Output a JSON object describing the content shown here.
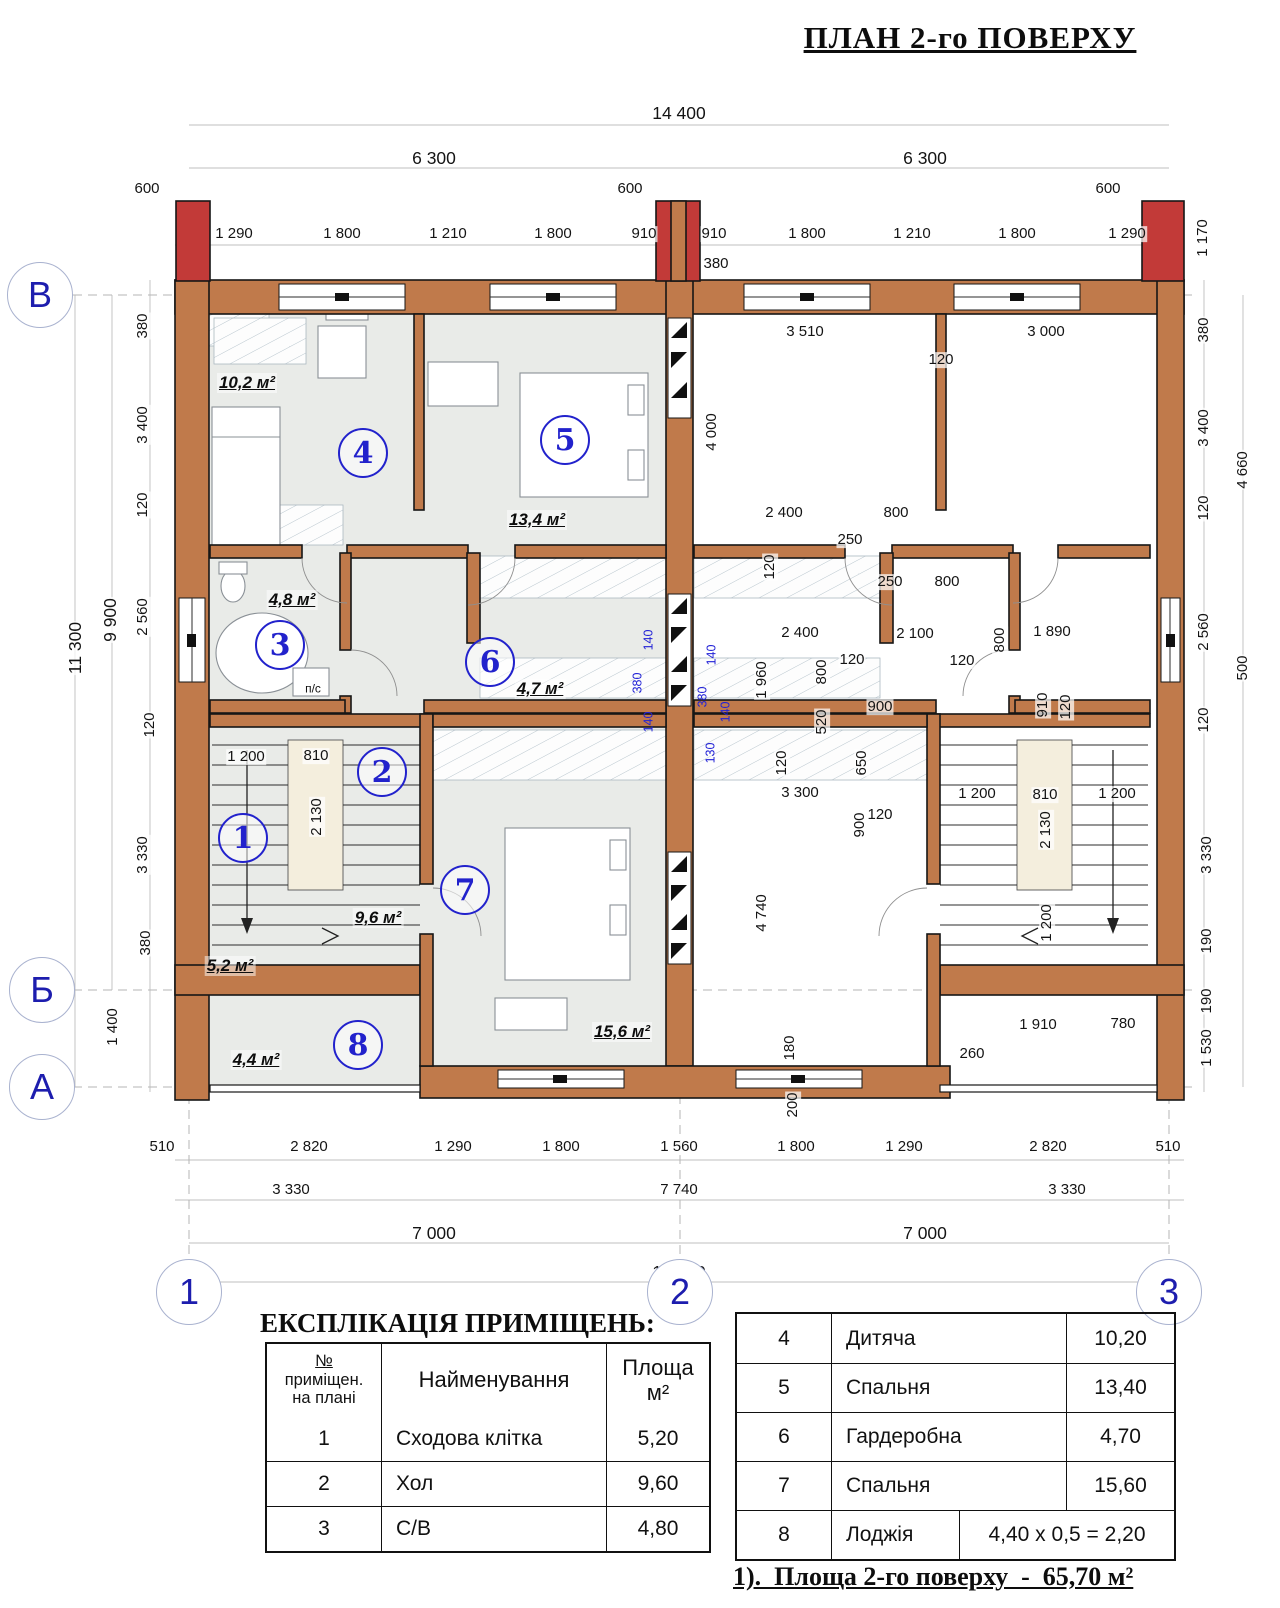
{
  "title": "ПЛАН 2-го ПОВЕРХУ",
  "colors": {
    "wall": "#c07a4b",
    "chimney": "#c23a38",
    "floor": "#e9ebe8",
    "stair_fill": "#f4eedd",
    "accent_blue": "#2222cc",
    "dim_blue": "#2121d6",
    "hatch_line": "#b9c6ce"
  },
  "plan": {
    "axis_circles": [
      {
        "label": "В",
        "x": 40,
        "y": 295
      },
      {
        "label": "Б",
        "x": 42,
        "y": 990
      },
      {
        "label": "А",
        "x": 42,
        "y": 1087
      },
      {
        "label": "1",
        "x": 189,
        "y": 1292
      },
      {
        "label": "2",
        "x": 680,
        "y": 1292
      },
      {
        "label": "3",
        "x": 1169,
        "y": 1292
      }
    ],
    "room_circles": [
      {
        "num": "1",
        "x": 243,
        "y": 838
      },
      {
        "num": "2",
        "x": 382,
        "y": 772
      },
      {
        "num": "3",
        "x": 280,
        "y": 645
      },
      {
        "num": "4",
        "x": 363,
        "y": 453
      },
      {
        "num": "5",
        "x": 565,
        "y": 440
      },
      {
        "num": "6",
        "x": 490,
        "y": 662
      },
      {
        "num": "7",
        "x": 465,
        "y": 890
      },
      {
        "num": "8",
        "x": 358,
        "y": 1045
      }
    ],
    "area_labels": [
      {
        "t": "10,2 м²",
        "x": 247,
        "y": 383
      },
      {
        "t": "13,4 м²",
        "x": 537,
        "y": 520
      },
      {
        "t": "4,8 м²",
        "x": 292,
        "y": 600
      },
      {
        "t": "4,7 м²",
        "x": 540,
        "y": 689
      },
      {
        "t": "9,6 м²",
        "x": 378,
        "y": 918
      },
      {
        "t": "5,2 м²",
        "x": 230,
        "y": 966
      },
      {
        "t": "15,6 м²",
        "x": 622,
        "y": 1032
      },
      {
        "t": "4,4 м²",
        "x": 256,
        "y": 1060
      }
    ],
    "dim_labels": [
      {
        "t": "14 400",
        "x": 679,
        "y": 113,
        "b": 1
      },
      {
        "t": "6 300",
        "x": 434,
        "y": 158,
        "b": 1
      },
      {
        "t": "6 300",
        "x": 925,
        "y": 158,
        "b": 1
      },
      {
        "t": "600",
        "x": 147,
        "y": 189
      },
      {
        "t": "600",
        "x": 630,
        "y": 189
      },
      {
        "t": "600",
        "x": 1108,
        "y": 189
      },
      {
        "t": "1 290",
        "x": 234,
        "y": 234
      },
      {
        "t": "1 800",
        "x": 342,
        "y": 234
      },
      {
        "t": "1 210",
        "x": 448,
        "y": 234
      },
      {
        "t": "1 800",
        "x": 553,
        "y": 234
      },
      {
        "t": "910",
        "x": 644,
        "y": 234
      },
      {
        "t": "910",
        "x": 714,
        "y": 234
      },
      {
        "t": "1 800",
        "x": 807,
        "y": 234
      },
      {
        "t": "1 210",
        "x": 912,
        "y": 234
      },
      {
        "t": "1 800",
        "x": 1017,
        "y": 234
      },
      {
        "t": "1 290",
        "x": 1127,
        "y": 234
      },
      {
        "t": "380",
        "x": 716,
        "y": 264
      },
      {
        "t": "1 170",
        "x": 1203,
        "y": 238,
        "r": 1
      },
      {
        "t": "11 300",
        "x": 75,
        "y": 648,
        "r": 1,
        "b": 1
      },
      {
        "t": "9 900",
        "x": 110,
        "y": 620,
        "r": 1,
        "b": 1
      },
      {
        "t": "380",
        "x": 143,
        "y": 326,
        "r": 1
      },
      {
        "t": "3 400",
        "x": 143,
        "y": 425,
        "r": 1
      },
      {
        "t": "120",
        "x": 143,
        "y": 505,
        "r": 1
      },
      {
        "t": "2 560",
        "x": 143,
        "y": 617,
        "r": 1
      },
      {
        "t": "120",
        "x": 150,
        "y": 725,
        "r": 1
      },
      {
        "t": "3 330",
        "x": 143,
        "y": 855,
        "r": 1
      },
      {
        "t": "380",
        "x": 146,
        "y": 943,
        "r": 1
      },
      {
        "t": "1 400",
        "x": 113,
        "y": 1027,
        "r": 1
      },
      {
        "t": "380",
        "x": 1204,
        "y": 330,
        "r": 1
      },
      {
        "t": "3 400",
        "x": 1204,
        "y": 428,
        "r": 1
      },
      {
        "t": "4 660",
        "x": 1243,
        "y": 470,
        "r": 1
      },
      {
        "t": "120",
        "x": 1204,
        "y": 508,
        "r": 1
      },
      {
        "t": "2 560",
        "x": 1204,
        "y": 632,
        "r": 1
      },
      {
        "t": "500",
        "x": 1243,
        "y": 668,
        "r": 1
      },
      {
        "t": "120",
        "x": 1204,
        "y": 720,
        "r": 1
      },
      {
        "t": "3 330",
        "x": 1207,
        "y": 855,
        "r": 1
      },
      {
        "t": "190",
        "x": 1207,
        "y": 941,
        "r": 1
      },
      {
        "t": "190",
        "x": 1207,
        "y": 1001,
        "r": 1
      },
      {
        "t": "1 530",
        "x": 1207,
        "y": 1048,
        "r": 1
      },
      {
        "t": "510",
        "x": 162,
        "y": 1147
      },
      {
        "t": "2 820",
        "x": 309,
        "y": 1147
      },
      {
        "t": "1 290",
        "x": 453,
        "y": 1147
      },
      {
        "t": "1 800",
        "x": 561,
        "y": 1147
      },
      {
        "t": "1 560",
        "x": 679,
        "y": 1147
      },
      {
        "t": "1 800",
        "x": 796,
        "y": 1147
      },
      {
        "t": "1 290",
        "x": 904,
        "y": 1147
      },
      {
        "t": "2 820",
        "x": 1048,
        "y": 1147
      },
      {
        "t": "510",
        "x": 1168,
        "y": 1147
      },
      {
        "t": "3 330",
        "x": 291,
        "y": 1190
      },
      {
        "t": "7 740",
        "x": 679,
        "y": 1190
      },
      {
        "t": "3 330",
        "x": 1067,
        "y": 1190
      },
      {
        "t": "7 000",
        "x": 434,
        "y": 1233,
        "b": 1
      },
      {
        "t": "7 000",
        "x": 925,
        "y": 1233,
        "b": 1
      },
      {
        "t": "14 000",
        "x": 679,
        "y": 1272,
        "b": 1
      },
      {
        "t": "1 200",
        "x": 246,
        "y": 757
      },
      {
        "t": "810",
        "x": 316,
        "y": 756
      },
      {
        "t": "2 130",
        "x": 317,
        "y": 817,
        "r": 1
      },
      {
        "t": "п/с",
        "x": 313,
        "y": 689,
        "s": 1
      },
      {
        "t": "3 510",
        "x": 805,
        "y": 332
      },
      {
        "t": "3 000",
        "x": 1046,
        "y": 332
      },
      {
        "t": "120",
        "x": 941,
        "y": 360
      },
      {
        "t": "4 000",
        "x": 712,
        "y": 432,
        "r": 1
      },
      {
        "t": "2 400",
        "x": 784,
        "y": 513
      },
      {
        "t": "800",
        "x": 896,
        "y": 513
      },
      {
        "t": "250",
        "x": 850,
        "y": 540
      },
      {
        "t": "120",
        "x": 770,
        "y": 567,
        "r": 1
      },
      {
        "t": "250",
        "x": 890,
        "y": 582
      },
      {
        "t": "800",
        "x": 947,
        "y": 582
      },
      {
        "t": "2 400",
        "x": 800,
        "y": 633
      },
      {
        "t": "2 100",
        "x": 915,
        "y": 634
      },
      {
        "t": "1 890",
        "x": 1052,
        "y": 632
      },
      {
        "t": "800",
        "x": 1000,
        "y": 640,
        "r": 1
      },
      {
        "t": "120",
        "x": 852,
        "y": 660
      },
      {
        "t": "120",
        "x": 962,
        "y": 661
      },
      {
        "t": "1 960",
        "x": 762,
        "y": 680,
        "r": 1
      },
      {
        "t": "800",
        "x": 822,
        "y": 672,
        "r": 1
      },
      {
        "t": "520",
        "x": 822,
        "y": 722,
        "r": 1
      },
      {
        "t": "900",
        "x": 880,
        "y": 707
      },
      {
        "t": "910",
        "x": 1043,
        "y": 705,
        "r": 1
      },
      {
        "t": "120",
        "x": 1066,
        "y": 707,
        "r": 1
      },
      {
        "t": "120",
        "x": 782,
        "y": 763,
        "r": 1
      },
      {
        "t": "650",
        "x": 862,
        "y": 763,
        "r": 1
      },
      {
        "t": "3 300",
        "x": 800,
        "y": 793
      },
      {
        "t": "1 200",
        "x": 977,
        "y": 794
      },
      {
        "t": "810",
        "x": 1045,
        "y": 795
      },
      {
        "t": "1 200",
        "x": 1117,
        "y": 794
      },
      {
        "t": "2 130",
        "x": 1046,
        "y": 830,
        "r": 1
      },
      {
        "t": "900",
        "x": 860,
        "y": 825,
        "r": 1
      },
      {
        "t": "120",
        "x": 880,
        "y": 815
      },
      {
        "t": "4 740",
        "x": 762,
        "y": 913,
        "r": 1
      },
      {
        "t": "1 200",
        "x": 1047,
        "y": 923,
        "r": 1
      },
      {
        "t": "180",
        "x": 790,
        "y": 1048,
        "r": 1
      },
      {
        "t": "200",
        "x": 793,
        "y": 1105,
        "r": 1
      },
      {
        "t": "1 910",
        "x": 1038,
        "y": 1025
      },
      {
        "t": "780",
        "x": 1123,
        "y": 1024
      },
      {
        "t": "260",
        "x": 972,
        "y": 1054
      },
      {
        "t": "140",
        "x": 649,
        "y": 640,
        "r": 1,
        "c": 1
      },
      {
        "t": "380",
        "x": 638,
        "y": 683,
        "r": 1,
        "c": 1
      },
      {
        "t": "140",
        "x": 649,
        "y": 722,
        "r": 1,
        "c": 1
      },
      {
        "t": "140",
        "x": 712,
        "y": 655,
        "r": 1,
        "c": 1
      },
      {
        "t": "380",
        "x": 703,
        "y": 697,
        "r": 1,
        "c": 1
      },
      {
        "t": "140",
        "x": 726,
        "y": 712,
        "r": 1,
        "c": 1
      },
      {
        "t": "130",
        "x": 711,
        "y": 753,
        "r": 1,
        "c": 1
      }
    ]
  },
  "legend": {
    "heading": "ЕКСПЛІКАЦІЯ ПРИМІЩЕНЬ:",
    "header": {
      "no_title": "№",
      "no_sub": "приміщен.\nна плані",
      "name": "Найменування",
      "area": "Площа\nм²"
    },
    "left_rows": [
      {
        "n": "1",
        "name": "Сходова клітка",
        "area": "5,20"
      },
      {
        "n": "2",
        "name": "Хол",
        "area": "9,60"
      },
      {
        "n": "3",
        "name": "С/В",
        "area": "4,80"
      }
    ],
    "right_rows": [
      {
        "n": "4",
        "name": "Дитяча",
        "area": "10,20"
      },
      {
        "n": "5",
        "name": "Спальня",
        "area": "13,40"
      },
      {
        "n": "6",
        "name": "Гардеробна",
        "area": "4,70"
      },
      {
        "n": "7",
        "name": "Спальня",
        "area": "15,60"
      },
      {
        "n": "8",
        "name": "Лоджія",
        "area": "4,40 х 0,5 = 2,20",
        "wide": true
      }
    ]
  },
  "note": "1).  Площа 2-го поверху  -  65,70 м²"
}
